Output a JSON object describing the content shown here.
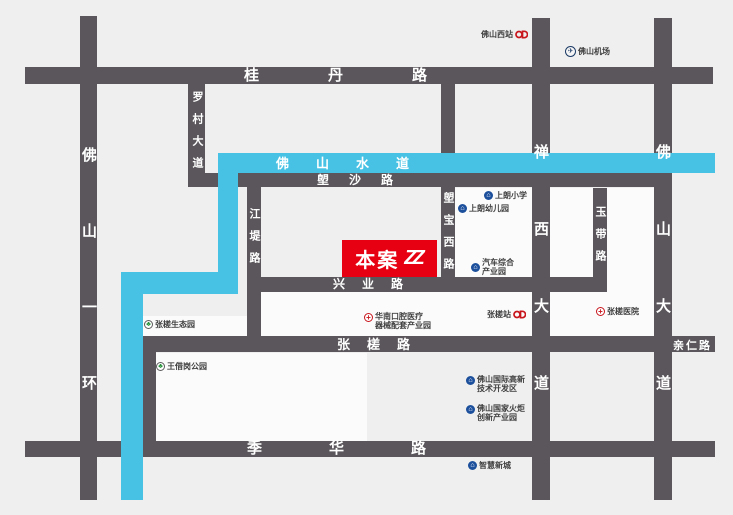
{
  "colors": {
    "background": "#efefef",
    "road": "#5a565b",
    "water": "#47c2e4",
    "marker_red": "#e60012",
    "poi_text": "#404040",
    "icon_blue": "#1c4f9c",
    "icon_green": "#27913c",
    "icon_red": "#c8161d",
    "icon_navy": "#1c3b66"
  },
  "marker": {
    "label": "本案",
    "logo": "ZZ"
  },
  "water_label": "佛山水道",
  "roads": {
    "guidan": "桂丹路",
    "langsha": "塱沙路",
    "xingye": "兴业路",
    "zhangcha": "张槎路",
    "qinren": "亲仁路",
    "jihua": "季华路",
    "yihuan": "佛山一环",
    "luocun": "罗村大道",
    "jiangdi": "江堤路",
    "langbao": "塱宝西路",
    "chanxi": "禅西大道",
    "yudai": "玉带路",
    "foshandadao": "佛山大道"
  },
  "icons": {
    "plane": "✈",
    "building": "⌂",
    "park": "♣",
    "cross": "+"
  },
  "pois": {
    "foshanxizhan": {
      "label": "佛山西站"
    },
    "foshanjichang": {
      "label": "佛山机场"
    },
    "shanglangxiaoxue": {
      "label": "上朗小学"
    },
    "shanglangyoueryuan": {
      "label": "上朗幼儿园"
    },
    "qichezonghe": {
      "line1": "汽车综合",
      "line2": "产业园"
    },
    "zhangchazhan": {
      "label": "张槎站"
    },
    "zhangchayiyuan": {
      "label": "张槎医院"
    },
    "huanankouqiang": {
      "line1": "华南口腔医疗",
      "line2": "器械配套产业园"
    },
    "zhangchashengtaiyuan": {
      "label": "张槎生态园"
    },
    "wangjiegang": {
      "label": "王借岗公园"
    },
    "gaoxinqu": {
      "line1": "佛山国际高新",
      "line2": "技术开发区"
    },
    "huoju": {
      "line1": "佛山国家火炬",
      "line2": "创新产业园"
    },
    "zhihuixincheng": {
      "label": "智慧新城"
    }
  }
}
